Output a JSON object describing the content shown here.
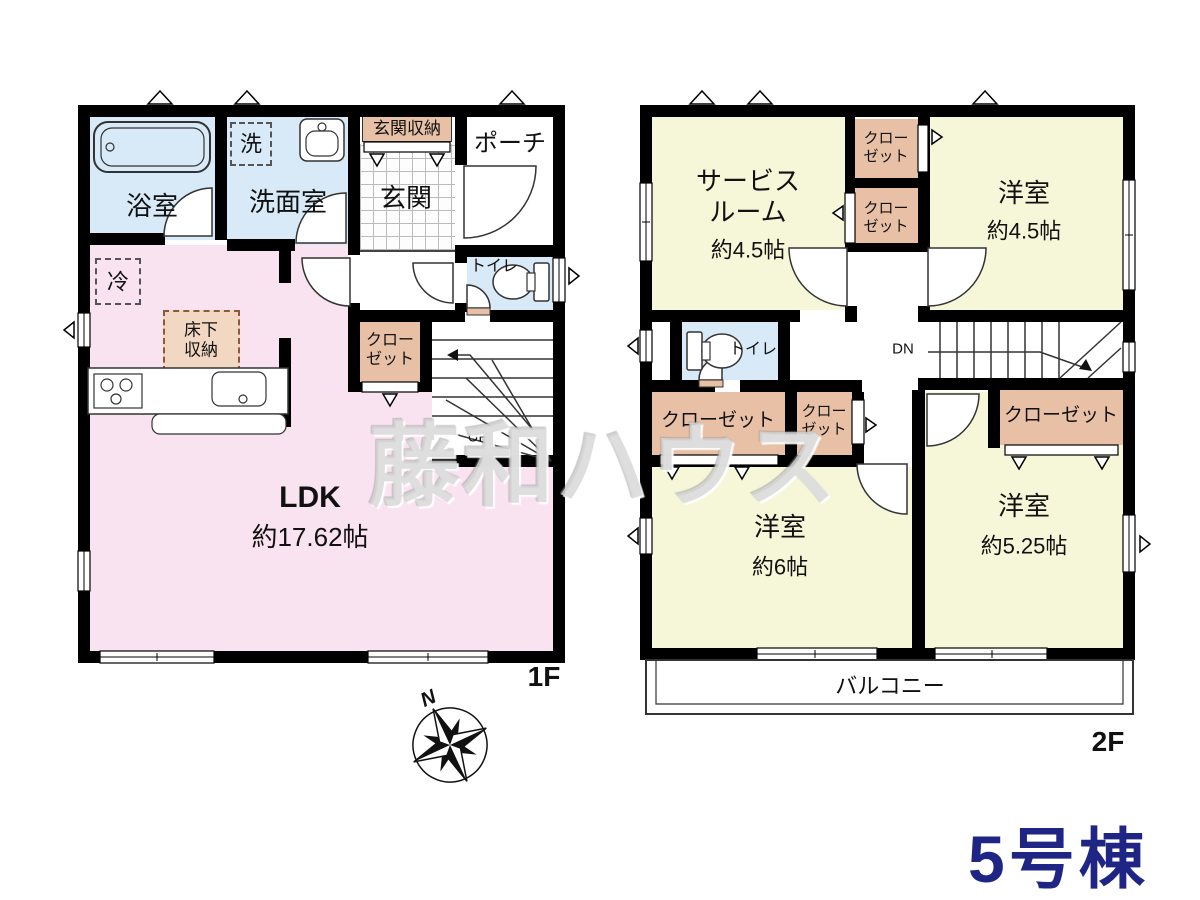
{
  "watermark": "藤和ハウス",
  "compass": {
    "n": "N"
  },
  "building_label": "5号棟",
  "terms": {
    "closet": "クローゼット",
    "toilet": "トイレ",
    "yoshitsu": "洋室",
    "up": "UP",
    "dn": "DN"
  },
  "floor1": {
    "label": "1F",
    "bath": "浴室",
    "washroom": "洗面室",
    "washer": "洗",
    "entrance_storage": "玄関収納",
    "entrance": "玄関",
    "porch": "ポーチ",
    "fridge": "冷",
    "underfloor_storage": "床下収納",
    "ldk": "LDK",
    "ldk_size": "約17.62帖"
  },
  "floor2": {
    "label": "2F",
    "service_room": "サービスルーム",
    "service_size": "約4.5帖",
    "yoshitsu45_size": "約4.5帖",
    "yoshitsu6_size": "約6帖",
    "yoshitsu525_size": "約5.25帖",
    "balcony": "バルコニー"
  },
  "colors": {
    "wall": "#000000",
    "wet_room": "#d8e9f8",
    "ldk": "#fae3f0",
    "bedroom": "#f6f6d8",
    "closet": "#e8c0a6",
    "accent": "#1e2584"
  }
}
